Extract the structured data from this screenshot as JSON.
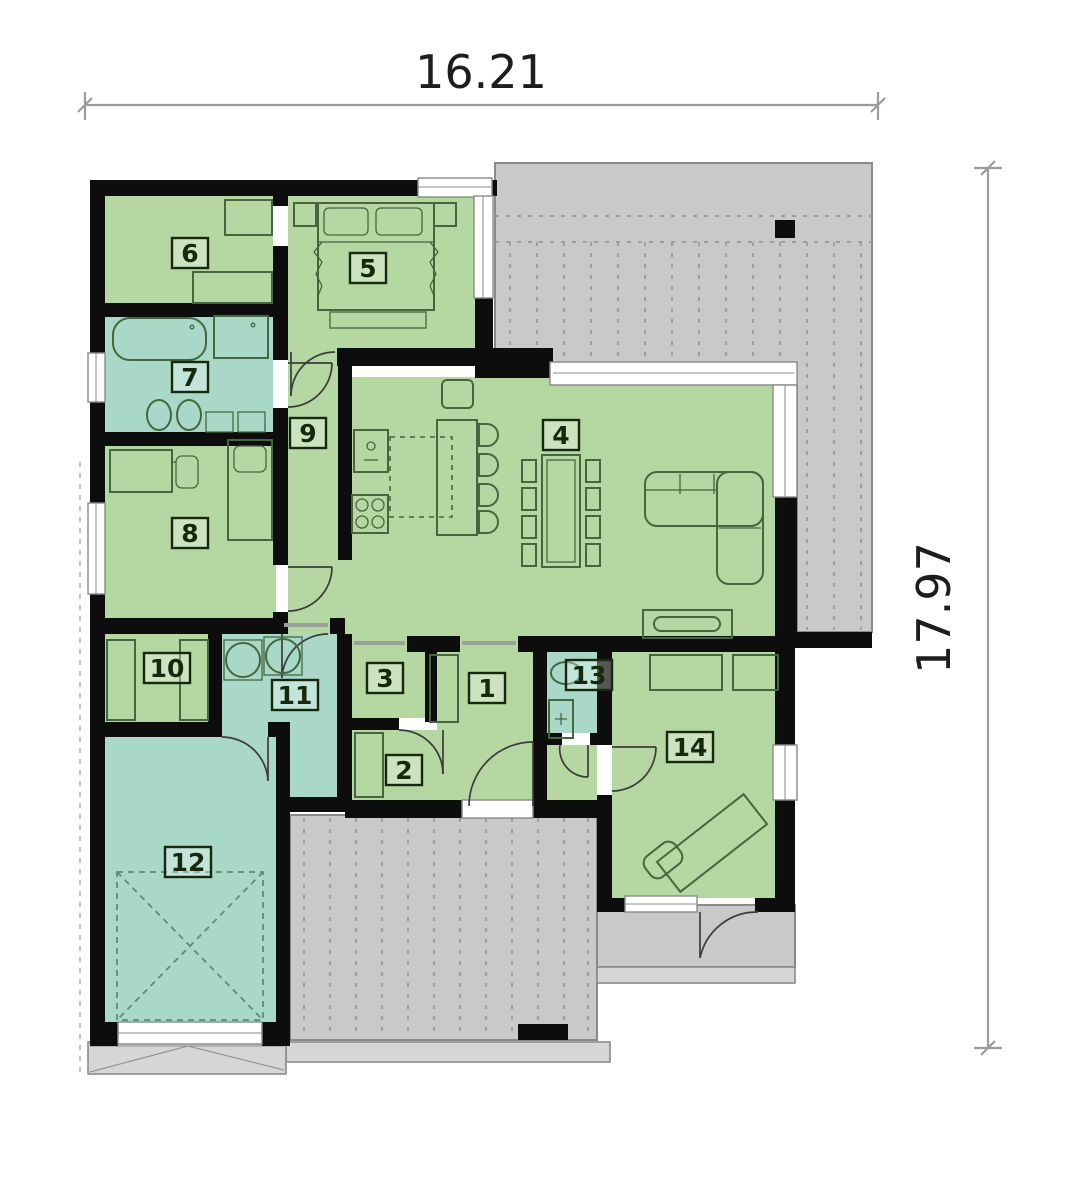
{
  "dimensions": {
    "width_label": "16.21",
    "height_label": "17.97"
  },
  "rooms": [
    {
      "number": "1"
    },
    {
      "number": "2"
    },
    {
      "number": "3"
    },
    {
      "number": "4"
    },
    {
      "number": "5"
    },
    {
      "number": "6"
    },
    {
      "number": "7"
    },
    {
      "number": "8"
    },
    {
      "number": "9"
    },
    {
      "number": "10"
    },
    {
      "number": "11"
    },
    {
      "number": "12"
    },
    {
      "number": "13"
    },
    {
      "number": "14"
    }
  ],
  "colors": {
    "room_green": "#b5d7a2",
    "room_teal": "#a9d8c8",
    "terrace_gray": "#c9c9c9",
    "step_gray": "#d6d6d6",
    "wall_black": "#0d0d0d",
    "furniture_green": "#44673f",
    "label_dark": "#16290f",
    "dim_gray": "#9b9b9b",
    "text_dark": "#1d1d1d",
    "border_gray": "#8a8a8a",
    "dash_gray": "#9e9e9e"
  }
}
